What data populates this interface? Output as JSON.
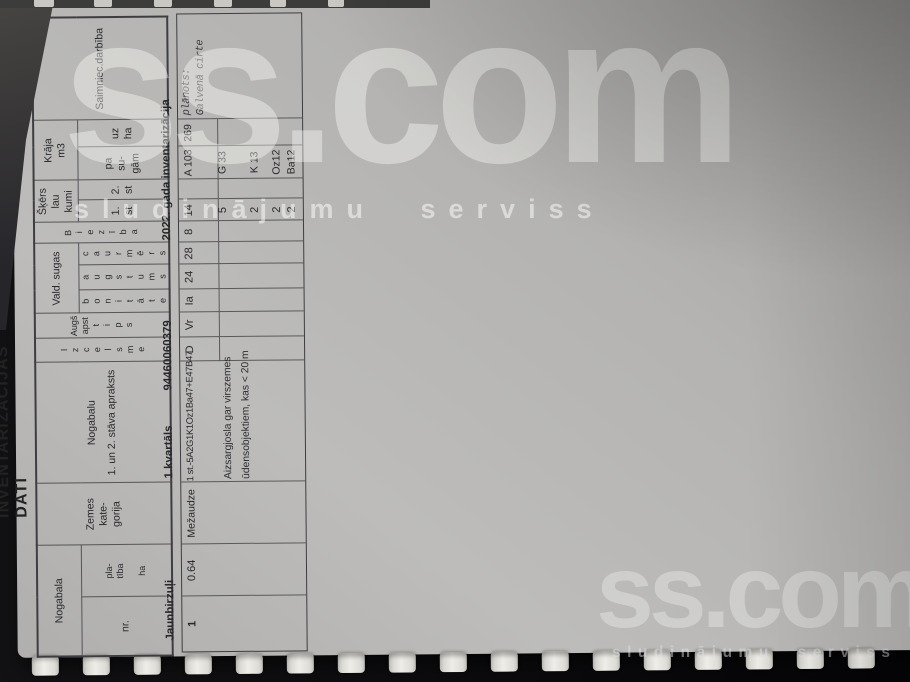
{
  "watermark": {
    "brand": "ss.com",
    "tagline": "sludinājumu serviss"
  },
  "page": {
    "number": "3",
    "title": "INVENTARIZĀCIJAS DATI"
  },
  "header": {
    "nogabala": "Nogabala",
    "nr": "nr.",
    "platiba": "pla-\ntība",
    "platiba_unit": "ha",
    "zemes": "Zemes\nkate-\ngorija",
    "apraksts": "Nogabalu\n1. un 2. stāva apraksts",
    "izcelsme": "Izcelsme",
    "augs_line1": "Augš",
    "augs_line2": "apst",
    "tips": "tips",
    "vald_sugas": "Vald. sugas",
    "bonitate": "bonitāte",
    "augstums": "augstums",
    "caurmers": "caurmērs",
    "bieziba_initial": "B",
    "bieziba_rest": "iezība",
    "skerslaukumi": "Šķērs\nlau\nkumi",
    "st1": "1.\nst",
    "st2": "2.\nst",
    "kraja": "Krāja\nm3",
    "pa_sugam": "pa\nsu-\ngām",
    "uz_ha": "uz\nha",
    "saimnieciba": "Saimniec.darbība"
  },
  "section": {
    "jaunbirzuli": "Jaunbirzuļi",
    "kvartals": "1.kvartāls",
    "kods": "94460060379",
    "inventarizacija": "2022. gada inventarizācija"
  },
  "row1": {
    "nr": "1",
    "platiba": "0.64",
    "kategorija": "Mežaudze",
    "formula": "1 st.-5A2G1K1Oz1Ba47+E47B47",
    "izcelsme": "D",
    "tips": "Vr",
    "bonitate": "Ia",
    "augstums": "24",
    "caurmers": "28",
    "bieziba": "8",
    "skerslaukums_1st": "14",
    "kraja_pa_sugam": "A 103",
    "kraja_uz_ha": "269",
    "saimn_line1": "plānots:",
    "saimn_line2": "Galvenā cirte"
  },
  "apraksts_piezime": {
    "line1": "Aizsargjosla gar virszemes",
    "line2": "ūdensobjektiem, kas < 20 m"
  },
  "species_rows": [
    {
      "sk": "5",
      "vol": "G 33"
    },
    {
      "sk": "2",
      "vol": "K 13"
    },
    {
      "sk": "2",
      "vol": "Oz12"
    },
    {
      "sk": "2",
      "vol": "Ba12"
    }
  ],
  "totals": {
    "platiba": [
      "0.64",
      "0.64"
    ],
    "kraja": [
      "173",
      "173"
    ]
  },
  "colors": {
    "paper": "#b5b4b2",
    "background": "#0b0b0d",
    "table_line": "#55555a",
    "watermark": "rgba(255,255,255,0.40)"
  }
}
